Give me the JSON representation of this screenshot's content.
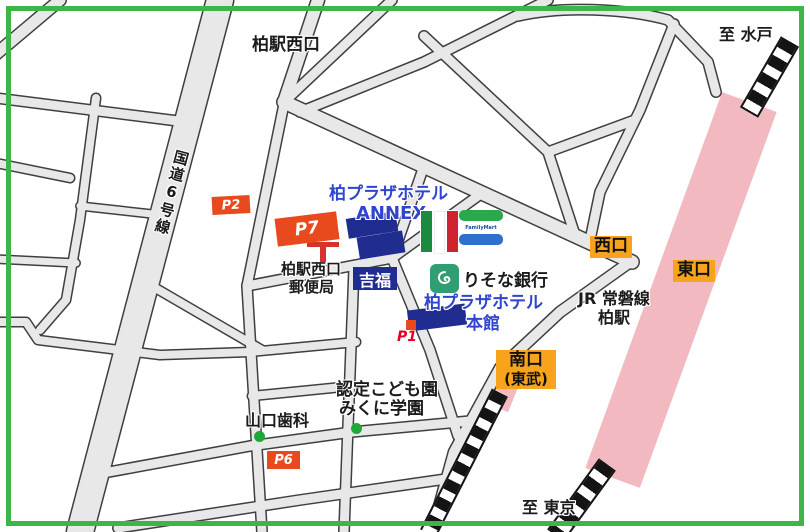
{
  "colors": {
    "frame_green": "#3cb549",
    "road_fill": "#e8e8e8",
    "road_casing": "#3f3f3f",
    "station_pink": "#f2b9c1",
    "exit_label_orange": "#f7a31b",
    "parking_red": "#e94a1d",
    "building_navy": "#202c90",
    "hotel_text_blue": "#2f45cf",
    "poi_dot_green": "#1fa83a",
    "postal_red": "#d6332b"
  },
  "area_labels": {
    "station_west_exit_street": "柏駅西口",
    "route6": "国道6号線",
    "to_mito": "至 水戸",
    "to_tokyo": "至 東京"
  },
  "station": {
    "jr_line": "JR 常磐線",
    "jr_station": "柏駅",
    "west_exit": "西口",
    "east_exit": "東口",
    "south_exit_line1": "南口",
    "south_exit_line2": "(東武)"
  },
  "hotel": {
    "annex_name": "柏プラザホテル",
    "annex_sub": "ANNEX",
    "main_name": "柏プラザホテル",
    "main_sub": "本館"
  },
  "parking": {
    "p1": "P1",
    "p2": "P2",
    "p6": "P6",
    "p7": "P7"
  },
  "pois": {
    "post_office_line1": "柏駅西口",
    "post_office_line2": "郵便局",
    "yoshifuku": "吉福",
    "resona_bank": "りそな銀行",
    "familymart": "FamilyMart",
    "yamaguchi_dental": "山口歯科",
    "mikuni_line1": "認定こども園",
    "mikuni_line2": "みくに学園"
  },
  "icons": {
    "postal_mark": "japan-post-mark",
    "resona_logo": "resona-swirl",
    "italian_flag": "italy-flag",
    "familymart_sign": "familymart-sign",
    "poi_dot": "green-dot-marker",
    "railway": "railway-track-stripes"
  }
}
